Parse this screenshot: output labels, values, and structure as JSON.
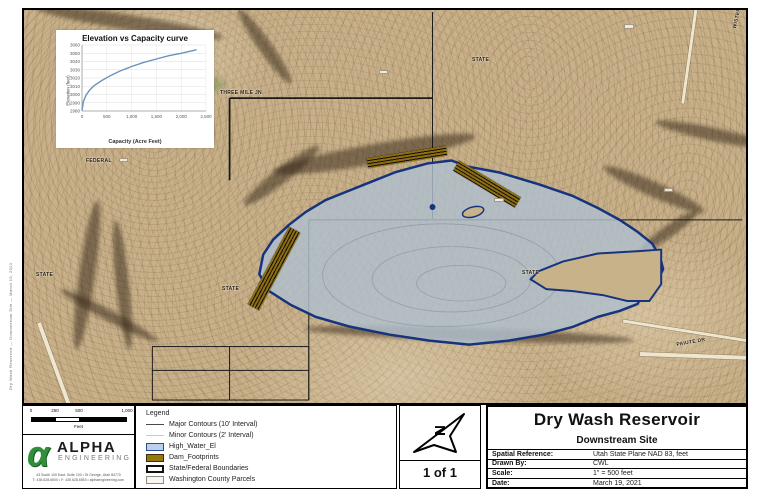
{
  "page": {
    "side_text": "Dry Wash Reservoir — Downstream Site — March 19, 2021"
  },
  "chart_data": {
    "type": "line",
    "title": "Elevation vs Capacity curve",
    "xlabel": "Capacity (Acre Feet)",
    "ylabel": "Elevation (feet)",
    "xlim": [
      0,
      2500
    ],
    "ylim": [
      2980,
      3060
    ],
    "x_ticks": [
      "0",
      "500",
      "1,000",
      "1,500",
      "2,000",
      "2,500"
    ],
    "y_ticks": [
      "3060",
      "3050",
      "3040",
      "3030",
      "3020",
      "3010",
      "3000",
      "2990",
      "2980"
    ],
    "grid": true,
    "legend_position": "none",
    "line_color": "#6b93be",
    "series": [
      {
        "name": "Elevation vs Capacity",
        "points": [
          [
            0,
            2981
          ],
          [
            30,
            2992
          ],
          [
            80,
            2999
          ],
          [
            150,
            3005
          ],
          [
            250,
            3011
          ],
          [
            400,
            3017
          ],
          [
            550,
            3022
          ],
          [
            750,
            3028
          ],
          [
            1000,
            3034
          ],
          [
            1250,
            3039
          ],
          [
            1500,
            3043
          ],
          [
            1750,
            3047
          ],
          [
            2000,
            3050
          ],
          [
            2150,
            3052
          ],
          [
            2300,
            3054
          ]
        ]
      }
    ]
  },
  "map": {
    "labels": [
      {
        "text": "THREE MILE JN",
        "x": 196,
        "y": 80,
        "rot": 0
      },
      {
        "text": "FEDERAL",
        "x": 62,
        "y": 148,
        "rot": 0
      },
      {
        "text": "STATE",
        "x": 448,
        "y": 47,
        "rot": 0
      },
      {
        "text": "STATE",
        "x": 12,
        "y": 262,
        "rot": 0
      },
      {
        "text": "STATE",
        "x": 198,
        "y": 276,
        "rot": 0
      },
      {
        "text": "STATE",
        "x": 498,
        "y": 260,
        "rot": 0
      },
      {
        "text": "PAIUTE DR",
        "x": 652,
        "y": 332,
        "rot": -10
      },
      {
        "text": "WISTERIA WAY",
        "x": 708,
        "y": 18,
        "rot": -78
      }
    ]
  },
  "legend": {
    "title": "Legend",
    "items": [
      {
        "label": "Major Contours (10' Interval)"
      },
      {
        "label": "Minor Contours (2' Interval)"
      },
      {
        "label": "High_Water_El"
      },
      {
        "label": "Dam_Footprints"
      },
      {
        "label": "State/Federal Boundaries"
      },
      {
        "label": "Washington County Parcels"
      }
    ]
  },
  "scalebar": {
    "ticks": [
      "0",
      "250",
      "500",
      "1,000"
    ],
    "unit": "Feet"
  },
  "logo": {
    "alpha": "α",
    "name": "ALPHA",
    "sub": "ENGINEERING",
    "address1": "43 South 100 East, Suite 100 • St George, Utah 84770",
    "address2": "T: 435.628.6500 • F: 435.628.6553 • alphaengineering.com"
  },
  "north": {
    "page_label": "1 of 1"
  },
  "titleblock": {
    "title": "Dry Wash Reservoir",
    "subtitle": "Downstream Site",
    "rows": [
      {
        "label": "Spatial Reference:",
        "value": "Utah State Plane NAD 83, feet"
      },
      {
        "label": "Drawn By:",
        "value": "CWL"
      },
      {
        "label": "Scale:",
        "value": "1\" = 500 feet"
      },
      {
        "label": "Date:",
        "value": "March 19, 2021"
      }
    ]
  }
}
